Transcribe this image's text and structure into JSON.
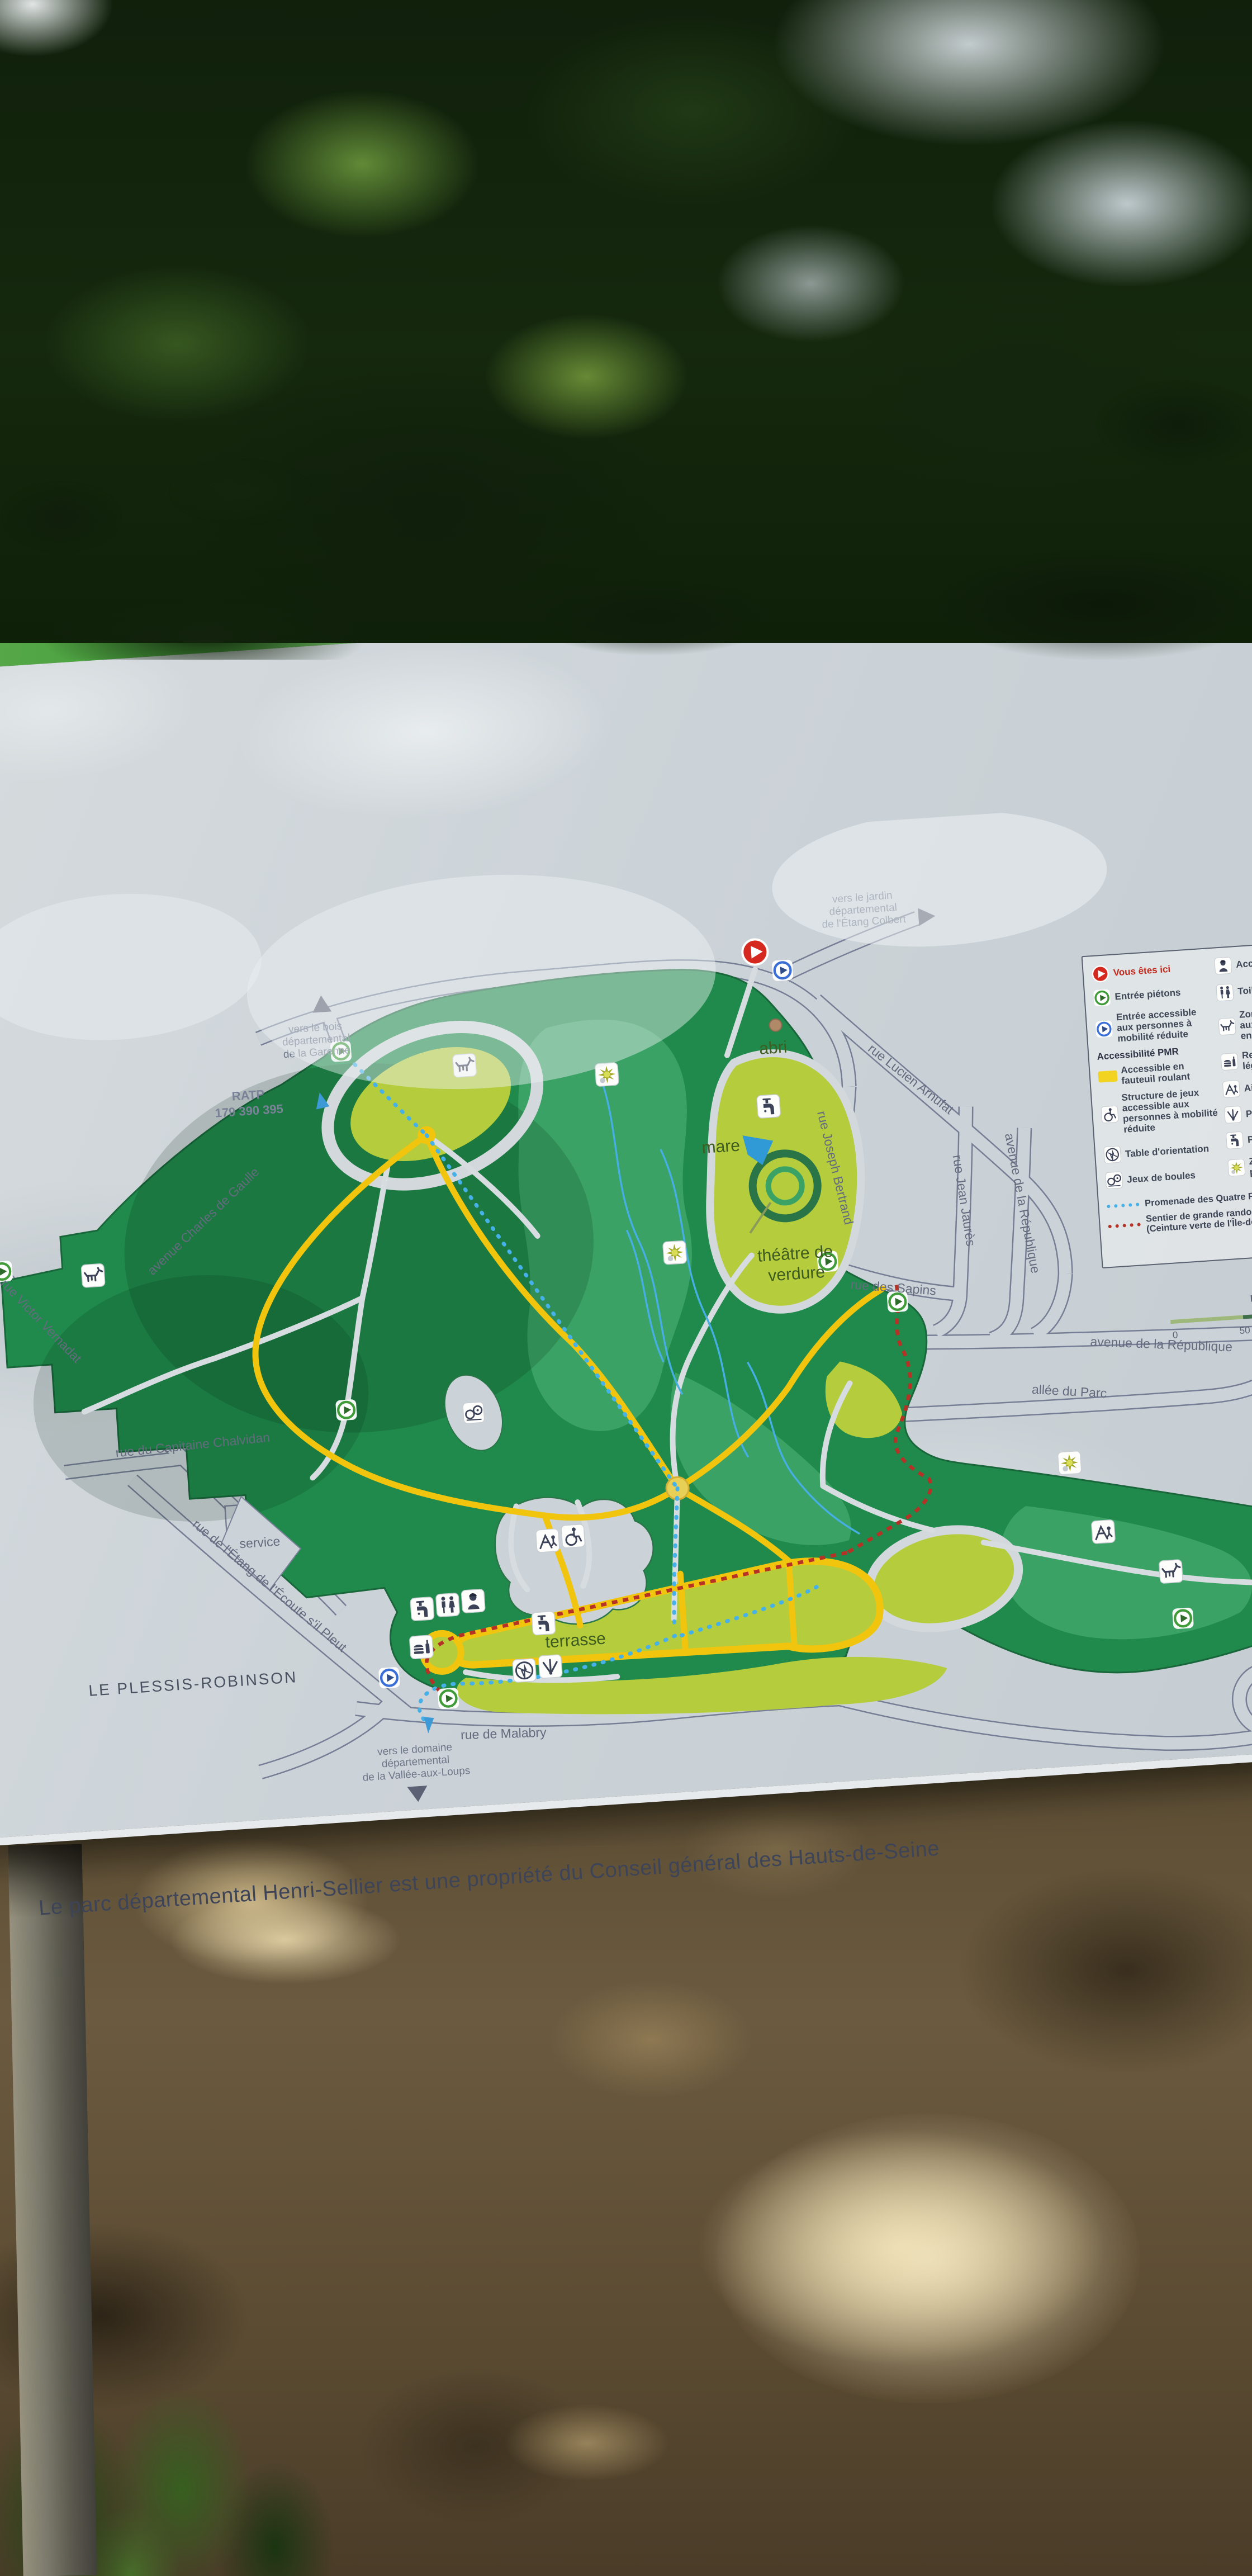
{
  "banner": {
    "title": "Parc départemental Henri-Sellier"
  },
  "panel": {
    "caption": "Le parc départemental Henri-Sellier est une propriété du Conseil général des Hauts-de-Seine"
  },
  "map": {
    "city": "LE PLESSIS-ROBINSON",
    "features": {
      "abri": "abri",
      "mare": "mare",
      "theatre1": "théâtre de",
      "theatre2": "verdure",
      "terrasse": "terrasse",
      "service": "service"
    },
    "bus": {
      "line1": "RATP",
      "line2": "179 390 395"
    },
    "north": "NORD",
    "scale0": "0",
    "scale50": "50",
    "streets": [
      {
        "name": "avenue Charles de Gaulle"
      },
      {
        "name": "rue Lucien Arnufat"
      },
      {
        "name": "rue Joseph Bertrand"
      },
      {
        "name": "rue des Sapins"
      },
      {
        "name": "rue Jean Jaurès"
      },
      {
        "name": "avenue de la République"
      },
      {
        "name": "avenue de la République"
      },
      {
        "name": "allée du Parc"
      },
      {
        "name": "rue du Capitaine Chalvidan"
      },
      {
        "name": "rue de l'Étang de l'Écoute s'il Pleut"
      },
      {
        "name": "rue Victor Vernadat"
      },
      {
        "name": "rue de Malabry"
      },
      {
        "name": "avenue de la République"
      }
    ],
    "directions": {
      "garenne": [
        "vers le bois",
        "départemental",
        "de la Garenne"
      ],
      "colbert": [
        "vers le jardin",
        "départemental",
        "de l'Étang Colbert"
      ],
      "vallee": [
        "vers le domaine",
        "départemental",
        "de la Vallée-aux-Loups"
      ]
    }
  },
  "legend": {
    "left": [
      {
        "icon": "you-are-here-icon",
        "label": "Vous êtes ici"
      },
      {
        "icon": "pedestrian-entrance-icon",
        "label": "Entrée piétons"
      },
      {
        "icon": "accessible-entrance-icon",
        "label": "Entrée accessible aux personnes à mobilité réduite"
      }
    ],
    "pmr_header": "Accessibilité PMR",
    "pmr": [
      {
        "icon": "wheelchair-path-swatch",
        "label": "Accessible en fauteuil roulant"
      },
      {
        "icon": "accessible-playground-icon",
        "label": "Structure de jeux accessible aux personnes à mobilité réduite"
      }
    ],
    "left2": [
      {
        "icon": "orientation-table-icon",
        "label": "Table d'orientation"
      },
      {
        "icon": "petanque-icon",
        "label": "Jeux de boules"
      }
    ],
    "right": [
      {
        "icon": "reception-icon",
        "label": "Accueil"
      },
      {
        "icon": "toilets-icon",
        "label": "Toilettes"
      },
      {
        "icon": "dogs-on-leash-icon",
        "label": "Zone accessible aux chiens tenus en laisse"
      },
      {
        "icon": "light-food-icon",
        "label": "Restauration légère"
      },
      {
        "icon": "playground-icon",
        "label": "Aire de jeux"
      },
      {
        "icon": "viewpoint-icon",
        "label": "Point de vue"
      },
      {
        "icon": "water-point-icon",
        "label": "Point eau"
      },
      {
        "icon": "protected-area-icon",
        "label": "Zone naturelle protégée"
      }
    ],
    "routes": [
      {
        "style": "blue-dashed",
        "label": "Promenade des Quatre Forêts"
      },
      {
        "style": "red-dashed",
        "label": "Sentier de grande randonnée de pays (Ceinture verte de l'Île-de-France)"
      }
    ]
  },
  "colors": {
    "banner_green": "#3f9c38",
    "park_dark_green": "#1f8a4b",
    "park_mid_green": "#3aa265",
    "park_light_green": "#b5cc3d",
    "path_yellow": "#f1c40e",
    "promenade_blue": "#45b1e8",
    "gr_trail_red": "#b63226",
    "you_are_here_red": "#d5281e",
    "panel_gray": "#ccd3d8"
  },
  "icons": {
    "you_are_here": "red disc with white play-triangle",
    "pedestrian_entrance": "green ring with dark triangle",
    "accessible_entrance": "blue ring with dark triangle",
    "north_arrow": "dark sail triangle",
    "protected_area": "yellow star burst",
    "water_point": "tap",
    "dog": "dog silhouette"
  }
}
